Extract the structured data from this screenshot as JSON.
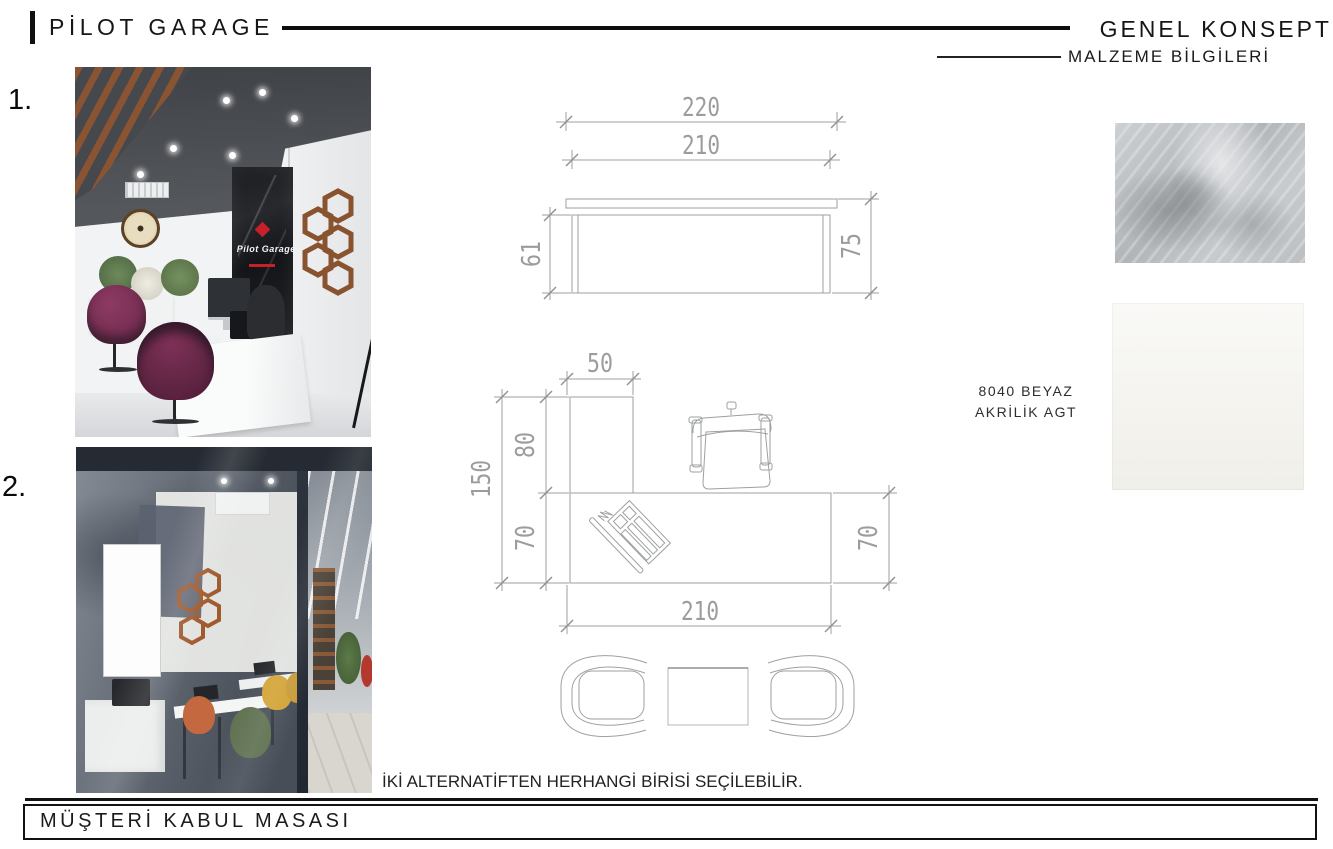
{
  "header": {
    "brand": "PİLOT GARAGE",
    "concept_title": "GENEL KONSEPT",
    "materials_title": "MALZEME BİLGİLERİ"
  },
  "reference_photos": [
    {
      "label": "1.",
      "overlay_text": "Pilot Garage"
    },
    {
      "label": "2."
    }
  ],
  "drawings": {
    "elevation_dims": {
      "top_width": "220",
      "body_width": "210",
      "body_height": "61",
      "total_height": "75"
    },
    "plan_dims": {
      "return_width": "50",
      "return_depth": "80",
      "total_depth": "150",
      "left_depth": "70",
      "right_depth": "70",
      "desk_width": "210"
    }
  },
  "materials": {
    "label_line1": "8040 BEYAZ",
    "label_line2": "AKRİLİK AGT"
  },
  "note_text": "İKİ ALTERNATİFTEN HERHANGİ BİRİSİ SEÇİLEBİLİR.",
  "footer": {
    "title": "MÜŞTERİ KABUL MASASI"
  },
  "colors": {
    "line_gray": "#9da0a2",
    "dim_text_gray": "#9a9c9e",
    "ink": "#141414",
    "logo_red": "#c8202a",
    "wood_brown": "#8a5330",
    "plum_chair": "#7c3156"
  }
}
